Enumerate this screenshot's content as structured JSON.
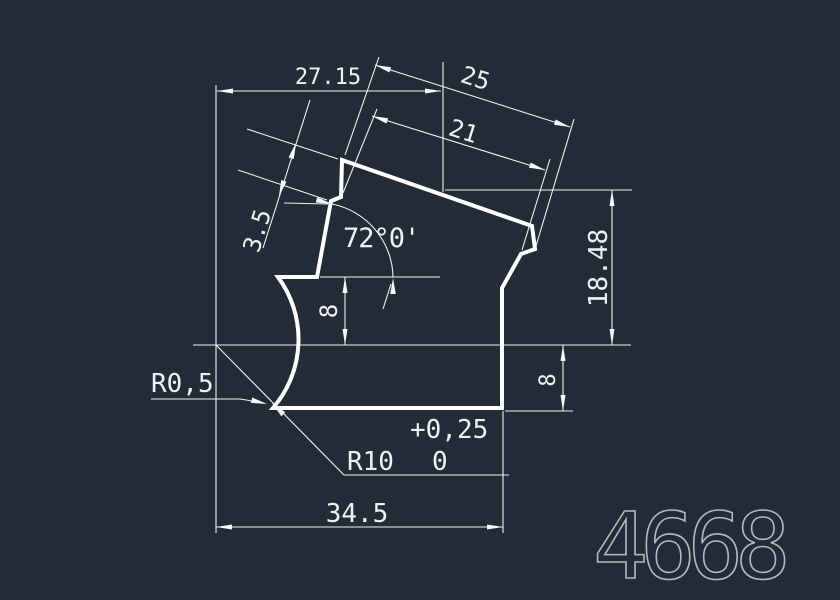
{
  "drawing": {
    "title": "extrusion-profile-section",
    "background_color": "#232b36",
    "line_color": "#ffffff",
    "text_color": "#eef1f4",
    "part_number": "4668",
    "dimensions": {
      "width_top": "27.15",
      "top_edge_outer": "25",
      "top_edge_inner": "21",
      "tab_thickness": "3.5",
      "angle": "72°0'",
      "left_step_height": "8",
      "right_height": "18.48",
      "right_step_height": "8",
      "corner_radius": "R0,5",
      "groove_radius": "R10",
      "groove_tol_upper": "+0,25",
      "groove_tol_lower": "0",
      "width_bottom": "34.5"
    }
  }
}
